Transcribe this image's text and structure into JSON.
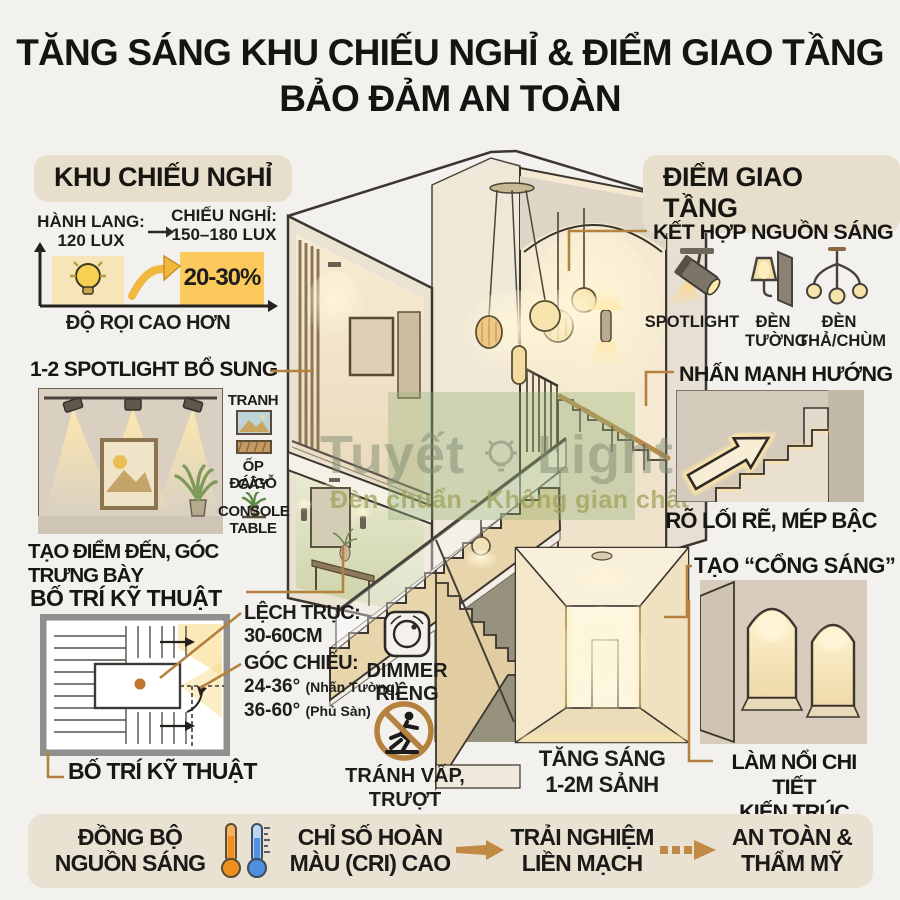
{
  "title": {
    "line1": "TĂNG SÁNG KHU CHIẾU NGHỈ & ĐIỂM GIAO TẦNG",
    "line2": "BẢO ĐẢM AN TOÀN"
  },
  "left": {
    "badge": "KHU CHIẾU NGHỈ",
    "lux": {
      "from_label": "HÀNH LANG:",
      "from_value": "120 LUX",
      "to_label": "CHIẾU NGHỈ:",
      "to_value": "150–180 LUX",
      "increase": "20-30%",
      "axis_label": "ĐỘ RỌI CAO HƠN"
    },
    "spotlight": {
      "heading": "1-2 SPOTLIGHT BỔ SUNG",
      "legend_tranh": "TRANH",
      "legend_op": "ỐP ĐÁ/GỖ",
      "legend_cay": "CÂY",
      "legend_console": "CONSOLE\nTABLE",
      "caption": "TẠO ĐIỂM ĐẾN, GÓC TRƯNG BÀY"
    },
    "technical": {
      "heading": "BỐ TRÍ KỸ THUẬT",
      "offset_label": "LỆCH TRỤC:",
      "offset_value": "30-60CM",
      "angle_label": "GÓC CHIẾU:",
      "angle_wall": "24-36°",
      "angle_wall_note": "(Nhấn Tường)",
      "angle_floor": "36-60°",
      "angle_floor_note": "(Phủ Sàn)",
      "caption": "BỐ TRÍ KỸ THUẬT"
    }
  },
  "center": {
    "dimmer_label": "DIMMER\nRIÊNG",
    "noslip_label": "TRÁNH VẤP,\nTRƯỢT",
    "hall_label": "TĂNG SÁNG\n1-2M SẢNH",
    "watermark_brand_1": "Tuyết",
    "watermark_brand_2": "Lights",
    "watermark_tagline": "Đèn chuẩn - Không gian chất"
  },
  "right": {
    "badge": "ĐIỂM GIAO TẦNG",
    "sources": {
      "heading": "KẾT HỢP NGUỒN SÁNG",
      "item_spotlight": "SPOTLIGHT",
      "item_wall": "ĐÈN\nTƯỜNG",
      "item_pendant": "ĐÈN\nTHẢ/CHÙM"
    },
    "direction": {
      "heading": "NHẤN MẠNH HƯỚNG",
      "caption": "RÕ LỐI RẼ, MÉP BẬC"
    },
    "gate": {
      "heading": "TẠO “CỔNG SÁNG”",
      "caption": "LÀM NỔI CHI TIẾT\nKIẾN TRÚC"
    }
  },
  "footer": {
    "item1": "ĐỒNG BỘ\nNGUỒN SÁNG",
    "item2": "CHỈ SỐ HOÀN\nMÀU (CRI) CAO",
    "item3": "TRẢI NGHIỆM\nLIỀN MẠCH",
    "item4": "AN TOÀN &\nTHẨM MỸ"
  },
  "colors": {
    "accent": "#b5813e",
    "badge_bg": "#e7decb",
    "highlight_yellow": "#fbc95c",
    "footer_bg": "#e9e1d1",
    "text": "#1e1d1b"
  }
}
